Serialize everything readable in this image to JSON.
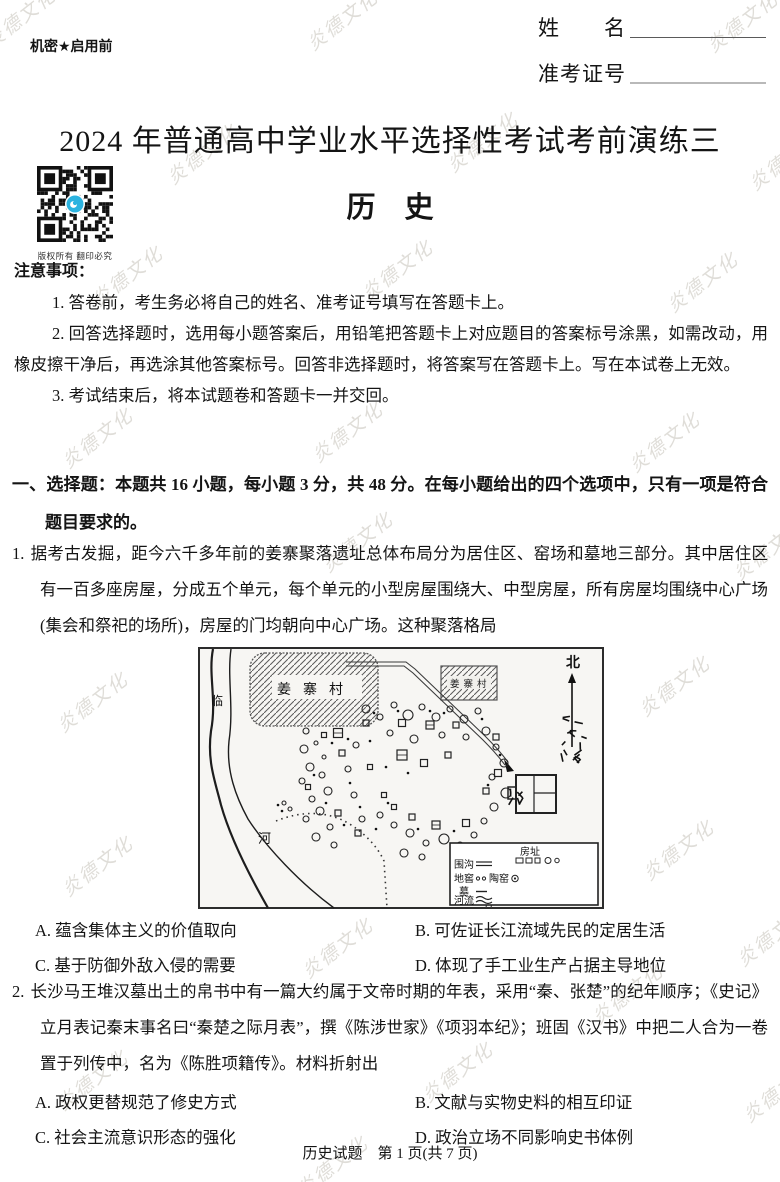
{
  "page": {
    "confidential": "机密★启用前",
    "name_label": "姓　　名",
    "ticket_label": "准考证号",
    "title": "2024 年普通高中学业水平选择性考试考前演练三",
    "subject": "历　史",
    "qr_caption": "版权所有 翻印必究",
    "watermark": "炎德文化",
    "footer": "历史试题　第 1 页(共 7 页)"
  },
  "notice": {
    "heading": "注意事项：",
    "items": [
      "1. 答卷前，考生务必将自己的姓名、准考证号填写在答题卡上。",
      "2. 回答选择题时，选用每小题答案后，用铅笔把答题卡上对应题目的答案标号涂黑，如需改动，用橡皮擦干净后，再选涂其他答案标号。回答非选择题时，将答案写在答题卡上。写在本试卷上无效。",
      "3. 考试结束后，将本试题卷和答题卡一并交回。"
    ]
  },
  "section1": {
    "heading": "一、选择题：本题共 16 小题，每小题 3 分，共 48 分。在每小题给出的四个选项中，只有一项是符合题目要求的。"
  },
  "questions": [
    {
      "number": "1.",
      "stem": "据考古发掘，距今六千多年前的姜寨聚落遗址总体布局分为居住区、窑场和墓地三部分。其中居住区有一百多座房屋，分成五个单元，每个单元的小型房屋围绕大、中型房屋，所有房屋均围绕中心广场(集会和祭祀的场所)，房屋的门均朝向中心广场。这种聚落格局",
      "options": [
        "A. 蕴含集体主义的价值取向",
        "B. 可佐证长江流域先民的定居生活",
        "C. 基于防御外敌入侵的需要",
        "D. 体现了手工业生产占据主导地位"
      ]
    },
    {
      "number": "2.",
      "stem": "长沙马王堆汉墓出土的帛书中有一篇大约属于文帝时期的年表，采用“秦、张楚”的纪年顺序；《史记》立月表记秦末事名曰“秦楚之际月表”，撰《陈涉世家》《项羽本纪》；班固《汉书》中把二人合为一卷置于列传中，名为《陈胜项籍传》。材料折射出",
      "options": [
        "A. 政权更替规范了修史方式",
        "B. 文献与实物史料的相互印证",
        "C. 社会主流意识形态的强化",
        "D. 政治立场不同影响史书体例"
      ]
    }
  ],
  "map": {
    "village_label_big": "姜寨村",
    "village_label_small": "姜寨村",
    "river_label_top": "临",
    "river_label_bottom": "河",
    "north_label": "北",
    "legend": {
      "house": "房址",
      "ditch": "围沟",
      "cellar": "地窖",
      "kiln": "陶窑",
      "tomb": "墓",
      "river": "河流"
    }
  }
}
